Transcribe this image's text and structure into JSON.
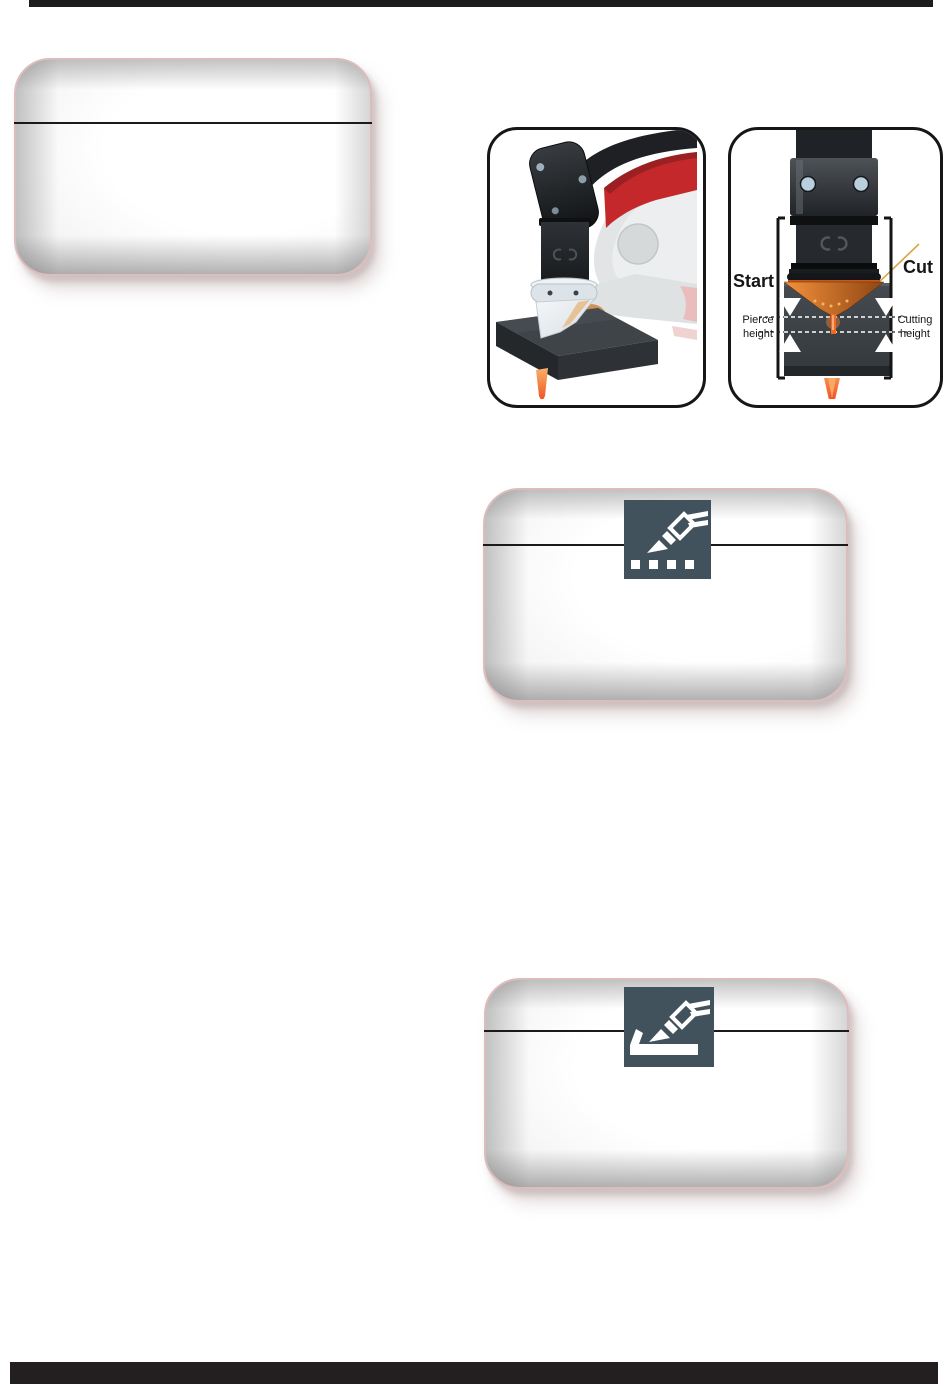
{
  "bars": {
    "top_color": "#1d1d1d",
    "bottom_color": "#231f20"
  },
  "panels": {
    "border_color": "#dcbcbc",
    "icon_tile_bg": "#41525d",
    "icons": {
      "dotted_cut_icon": "torch-dotted-line-cut-icon",
      "edge_start_icon": "torch-edge-start-icon"
    }
  },
  "figure_heights": {
    "start_label": "Start",
    "cut_label": "Cut",
    "pierce_height_label": "Pierce height",
    "cutting_height_label": "Cutting height"
  },
  "colors": {
    "flame_orange": "#ee4f1e",
    "nozzle_orange": "#e87a2a",
    "plate_gray": "#3a4045",
    "torch_black": "#26292d",
    "accent_red": "#c4282a",
    "ghost_gray": "#e0e2e3",
    "screw_blue": "#b9cfdb"
  }
}
